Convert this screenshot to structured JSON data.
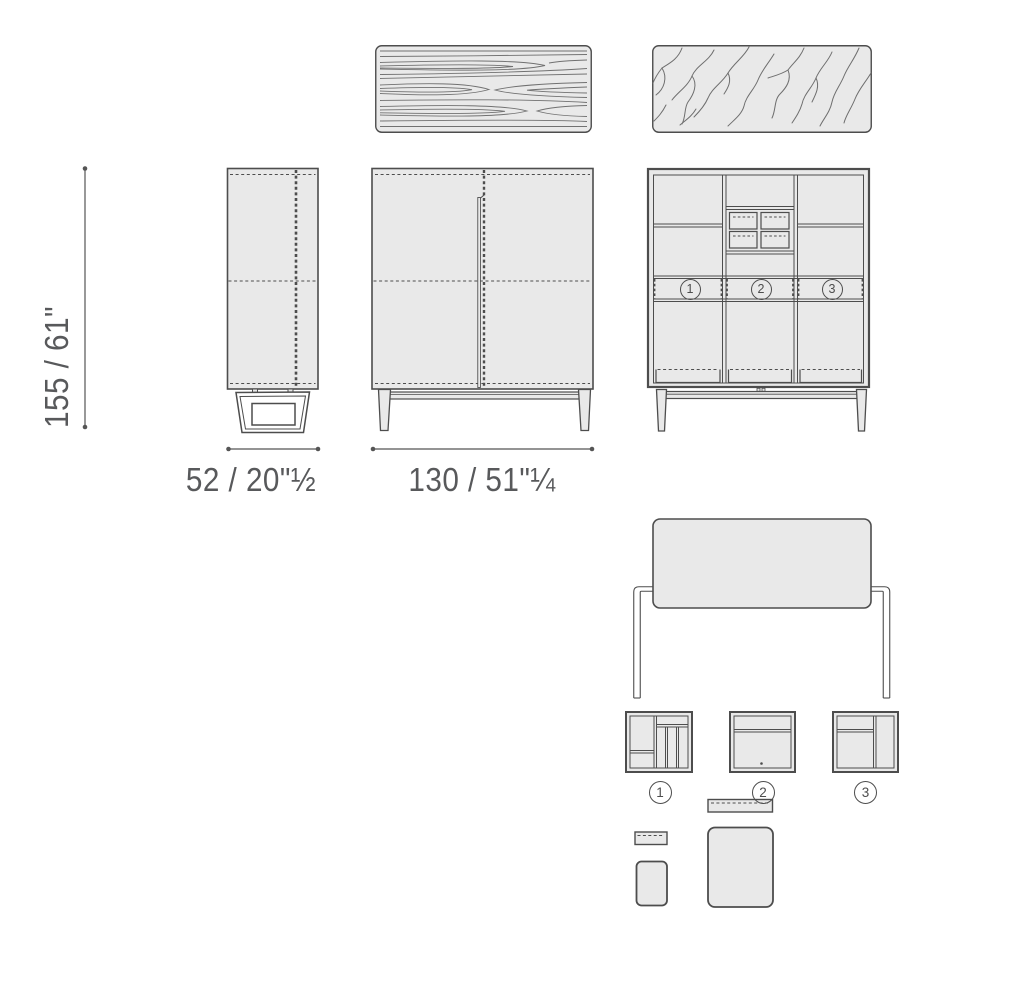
{
  "colors": {
    "background": "#ffffff",
    "panel_fill": "#e9e9e9",
    "line": "#4d4d4d",
    "text": "#58595b"
  },
  "dimensions": {
    "height": "155 / 61\"",
    "side_width": "52 / 20\"½",
    "front_width": "130 / 51\"¼"
  },
  "interior": {
    "compartments": [
      {
        "number": "1"
      },
      {
        "number": "2"
      },
      {
        "number": "3"
      }
    ]
  },
  "inserts": {
    "labels": [
      {
        "number": "1"
      },
      {
        "number": "2"
      },
      {
        "number": "3"
      }
    ]
  }
}
